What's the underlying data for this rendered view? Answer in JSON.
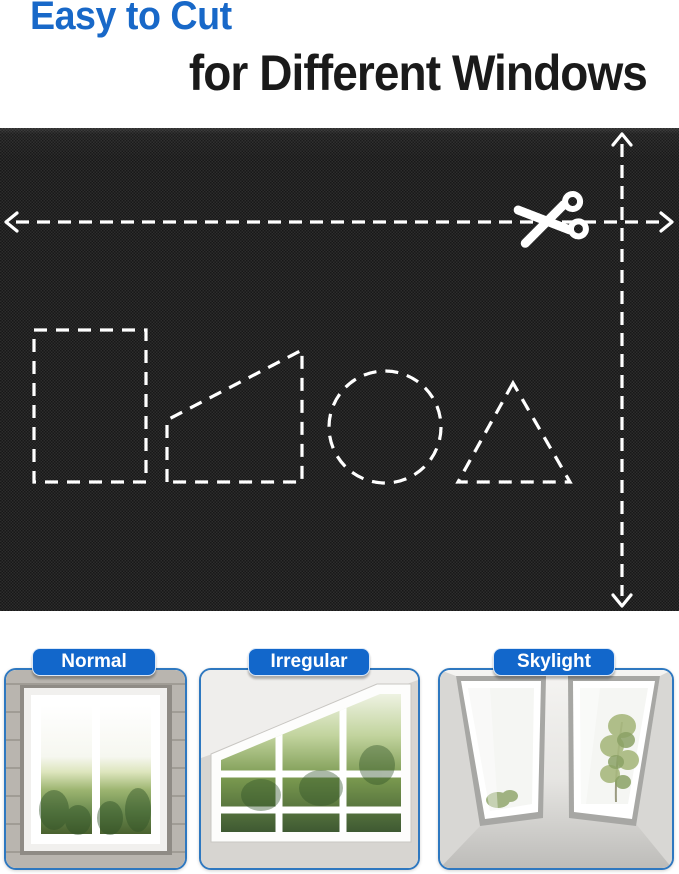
{
  "title": {
    "line1": "Easy to Cut",
    "line2": "for Different Windows"
  },
  "fabric_panel": {
    "cut_guide_shapes": [
      "rectangle",
      "trapezoid",
      "circle",
      "triangle"
    ],
    "icons": [
      "scissors-icon",
      "horizontal-cut-line-arrows",
      "vertical-cut-line-arrows"
    ]
  },
  "window_cards": [
    {
      "label": "Normal"
    },
    {
      "label": "Irregular"
    },
    {
      "label": "Skylight"
    }
  ],
  "colors": {
    "headline_blue": "#1868c8",
    "headline_dark": "#1a1a1a",
    "label_pill_bg": "#1267cb",
    "label_pill_text": "#ffffff",
    "card_border_blue": "#2e78c0",
    "fabric_base": "#202020",
    "cut_line_white": "#ffffff"
  }
}
